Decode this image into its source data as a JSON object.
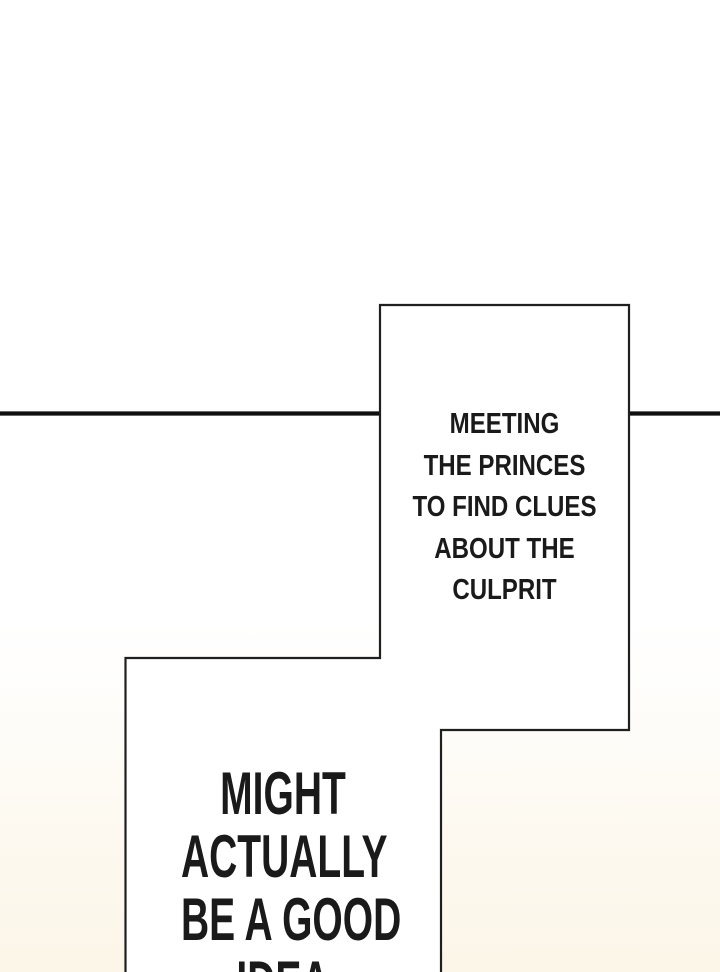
{
  "theme": {
    "page_bg_top": "#ffffff",
    "page_bg_bottom": "#fcf6e8",
    "panel_fill": "#ffffff",
    "panel_border": "#1f1f1f",
    "divider_color": "#0f0f0f",
    "text_color": "#1a1a1a"
  },
  "captions": {
    "top": {
      "lines": [
        "MEETING",
        "THE PRINCES",
        "TO FIND CLUES",
        "ABOUT THE",
        "CULPRIT"
      ]
    },
    "bottom": {
      "lines": [
        "MIGHT",
        "ACTUALLY",
        "BE A GOOD",
        "IDEA"
      ]
    }
  }
}
